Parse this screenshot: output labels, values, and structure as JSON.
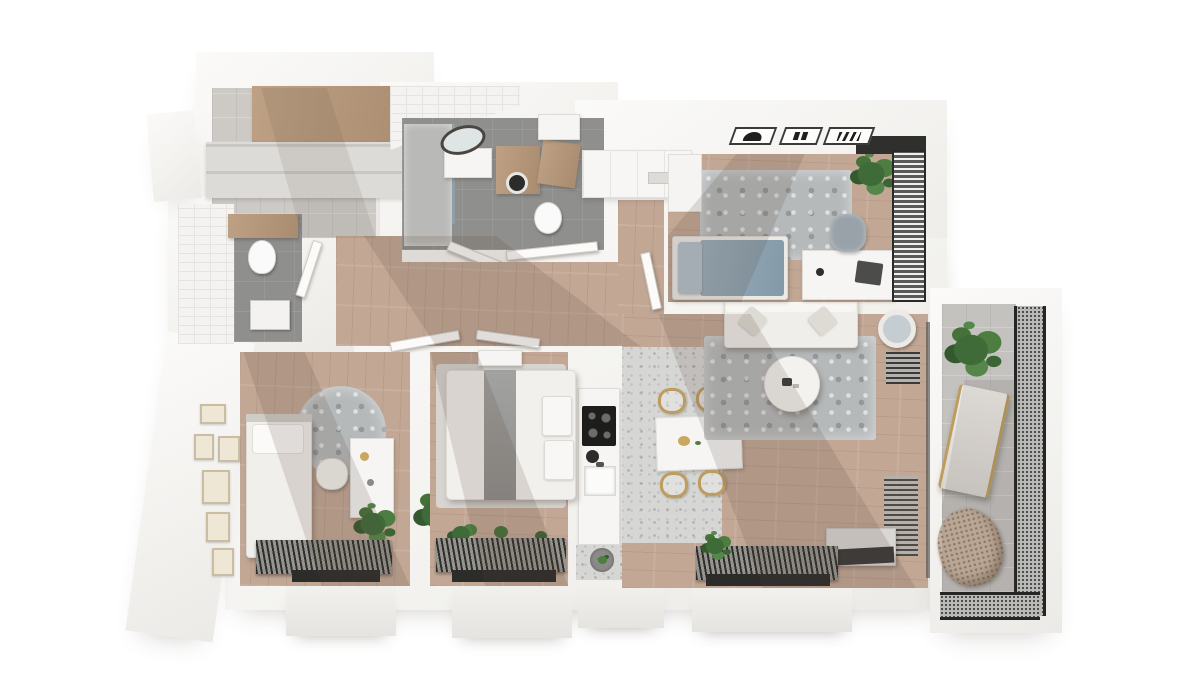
{
  "scene": {
    "title": "3D rendered apartment floor plan, top-down isometric view",
    "background_color": "#ffffff"
  },
  "palette": {
    "wall_white": "#f3f2ef",
    "wood_floor": "#c2a795",
    "entry_concrete": "#cdcac6",
    "bathroom_floor": "#8f8f8d",
    "tile_wall": "#f4f3f1",
    "kitchen_terrazzo": "#d6d6d4",
    "rug_gray": "#b6b9ba",
    "sofa_white": "#f0eeea",
    "bed_blue_gray": "#8fa4b2",
    "brass_gold": "#bd9c5d",
    "plant_green": "#4e7d42",
    "radiator_dark": "#2e2e2c",
    "wood_furniture": "#b49a7e"
  },
  "rooms": {
    "entry": {
      "label": "Entry hall",
      "items": [
        "wardrobe wood top",
        "gray cabinet fronts",
        "concrete floor"
      ]
    },
    "wc": {
      "label": "Guest WC",
      "items": [
        "white tiled wall",
        "wood counter",
        "toilet",
        "washbasin",
        "door"
      ]
    },
    "bathroom": {
      "label": "Bathroom",
      "items": [
        "shower",
        "washbasin",
        "oval mirror",
        "washing machine",
        "wood bench",
        "toilet",
        "double doors"
      ]
    },
    "kitchen": {
      "label": "Kitchen",
      "items": [
        "upper cabinet run",
        "counter",
        "induction cooktop",
        "sink",
        "kettle",
        "plant pot"
      ]
    },
    "dining": {
      "label": "Dining area",
      "items": [
        "white table",
        "four gold chairs",
        "terrazzo floor"
      ]
    },
    "bedroom": {
      "label": "Bedroom",
      "items": [
        "double bed blue-gray",
        "area rug",
        "desk",
        "laptop",
        "desk chair",
        "plant",
        "slatted wardrobe wall",
        "white closet"
      ]
    },
    "living": {
      "label": "Living room",
      "items": [
        "white sofa",
        "area rug",
        "round coffee table",
        "round standing mirror",
        "wall radiators",
        "tv cabinet",
        "window with radiator",
        "plant"
      ]
    },
    "kids": {
      "label": "Kids room",
      "items": [
        "single bed",
        "round rug",
        "desk",
        "shell chair",
        "two plants",
        "six picture frames",
        "window with radiator"
      ]
    },
    "master": {
      "label": "Master bedroom",
      "items": [
        "double bed",
        "gray runner blanket",
        "two pillows",
        "console",
        "plant",
        "window with plants"
      ]
    },
    "balcony": {
      "label": "Balcony",
      "items": [
        "concrete floor",
        "mesh railing",
        "plant",
        "lounger chair",
        "hanging rattan chair"
      ]
    },
    "hallway": {
      "label": "Hallway",
      "items": [
        "wood floor",
        "open door leaves"
      ]
    }
  },
  "wall_symbols": [
    {
      "name": "hood-symbol",
      "glyph": "filled mound"
    },
    {
      "name": "switch-symbol",
      "glyph": "two bars"
    },
    {
      "name": "vent-symbol",
      "glyph": "four slanted bars"
    }
  ]
}
